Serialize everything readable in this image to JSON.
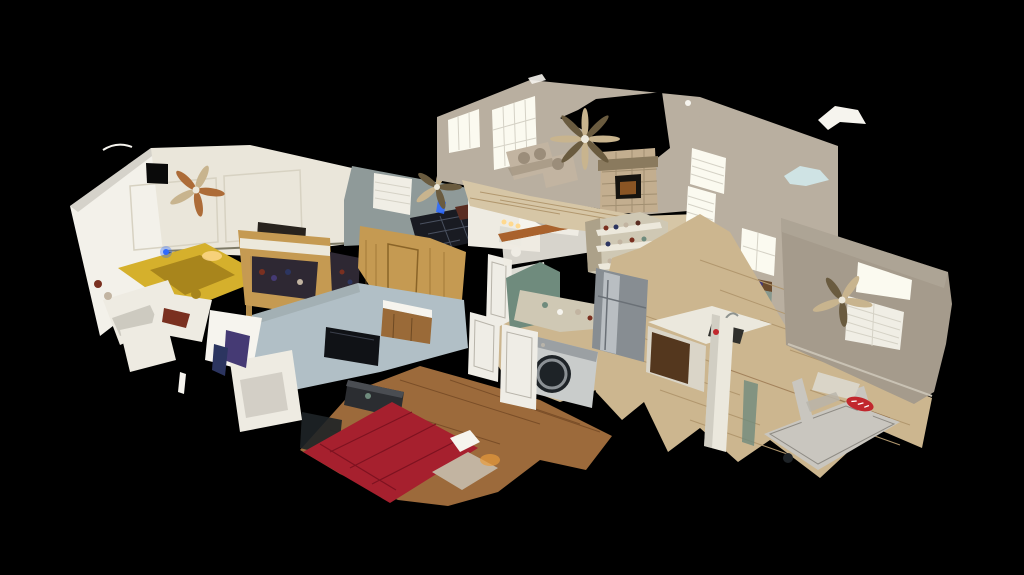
{
  "scene": {
    "description": "3D dollhouse cutaway view of a single-story home interior rendered on a black background: a gabled bedroom with a yellow bed, walk-in closets, a bedroom with a dark plaid bed, hall bathroom with tub, master bedroom with red bed and wall-mounted TV, kitchen with stainless refrigerator, white island and front-load washer, living room with stone fireplace, beige recliner sofa and ceiling fans, and a family/exercise room with a treadmill on light wood flooring."
  },
  "colors": {
    "bg": "#000000",
    "black": "#0a0a0a",
    "gable": "#f3f1ea",
    "cream": "#eae6da",
    "panel": "#d7d2c2",
    "gray": "#8f9a99",
    "greige": "#b9afa0",
    "taupe": "#a59b8c",
    "bluewall": "#b1bfc6",
    "winb": "#fbfaf0",
    "shutter": "#f0eee5",
    "louver": "#d5d2c6",
    "stone": "#c3ae8f",
    "mantel": "#8a7a5e",
    "insert": "#15130f",
    "fglow": "#8a5524",
    "sofa": "#c2b4a1",
    "sofash": "#9b8d7a",
    "ash": "#ccb68f",
    "ashline": "#b1976e",
    "warm": "#9c6a3b",
    "warmline": "#7a4e28",
    "pale": "#d6c6a6",
    "ybed": "#d5b02c",
    "ybedd": "#a8851c",
    "rbed": "#a6202e",
    "rbedd": "#7e1220",
    "pbed": "#191b22",
    "pline": "#4a5160",
    "hboard": "#5a2d22",
    "wcloset": "#c59a52",
    "wclosetd": "#8a6428",
    "shelfw": "#ece8db",
    "clothes": "#2e2833",
    "teal": "#6f8b7d",
    "clutter": "#cfc8b4",
    "steel": "#878d92",
    "steelhi": "#b9bec2",
    "isl": "#ebe8dd",
    "islb": "#dad5c8",
    "dw": "#54371e",
    "sink": "#30302c",
    "washer": "#c9cccb",
    "wdoor": "#1e2327",
    "hutch": "#87988e",
    "hutchtop": "#6a4a2c",
    "bronze": "#ad6c38",
    "fantan": "#c8b48e",
    "fandark": "#6a5b3f",
    "tv": "#101216",
    "white": "#eeebe2",
    "whiteb": "#f6f4ee",
    "shadow": "#b8b4aa",
    "purple": "#453a74",
    "navy": "#2c3560",
    "maroon": "#7a3020",
    "logo": "#c1272d",
    "glow": "#e89b3c",
    "glowc": "#ffd98e",
    "bglow": "#2f6bff",
    "candle": "#ffd9a0",
    "pblue": "#cfe3e4",
    "crate": "#28231d",
    "dresser": "#2b2d31",
    "dressert": "#4a4d52",
    "vwood": "#9a6a38",
    "tread": "#c9c6bf",
    "treade": "#8e8b84",
    "tile": "#dcdcd4",
    "door": "#efede6",
    "rust": "#a9622d",
    "louverline": "#d5d2c6"
  }
}
